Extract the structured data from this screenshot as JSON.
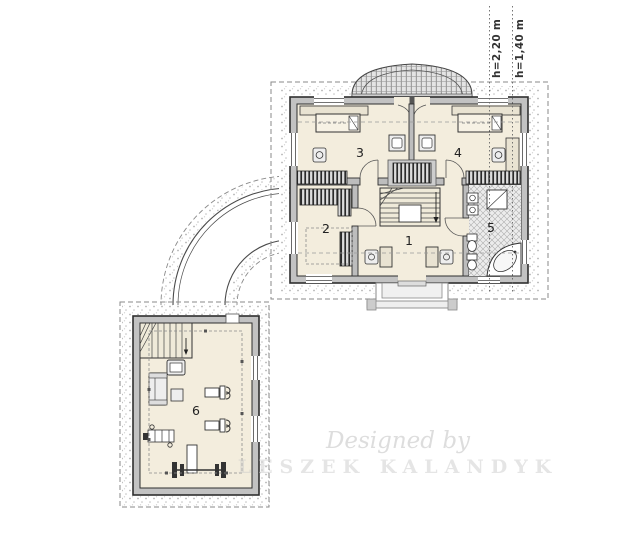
{
  "annotations": {
    "height_lines": [
      {
        "label": "h=2,20 m"
      },
      {
        "label": "h=1,40 m"
      }
    ]
  },
  "rooms": [
    {
      "number": "1"
    },
    {
      "number": "2"
    },
    {
      "number": "3"
    },
    {
      "number": "4"
    },
    {
      "number": "5"
    },
    {
      "number": "6"
    }
  ],
  "watermark": {
    "line1": "Designed by",
    "line2": "LESZEK KALANDYK"
  },
  "colors": {
    "floor": "#f3eddd",
    "wall_fill": "#c2c2c2",
    "wall_stroke": "#2e2e2e",
    "hatch_dark": "#2a2a2a",
    "dashed_line": "#777777",
    "stipple": "#b3b3b3",
    "tile_base": "#ececec"
  }
}
